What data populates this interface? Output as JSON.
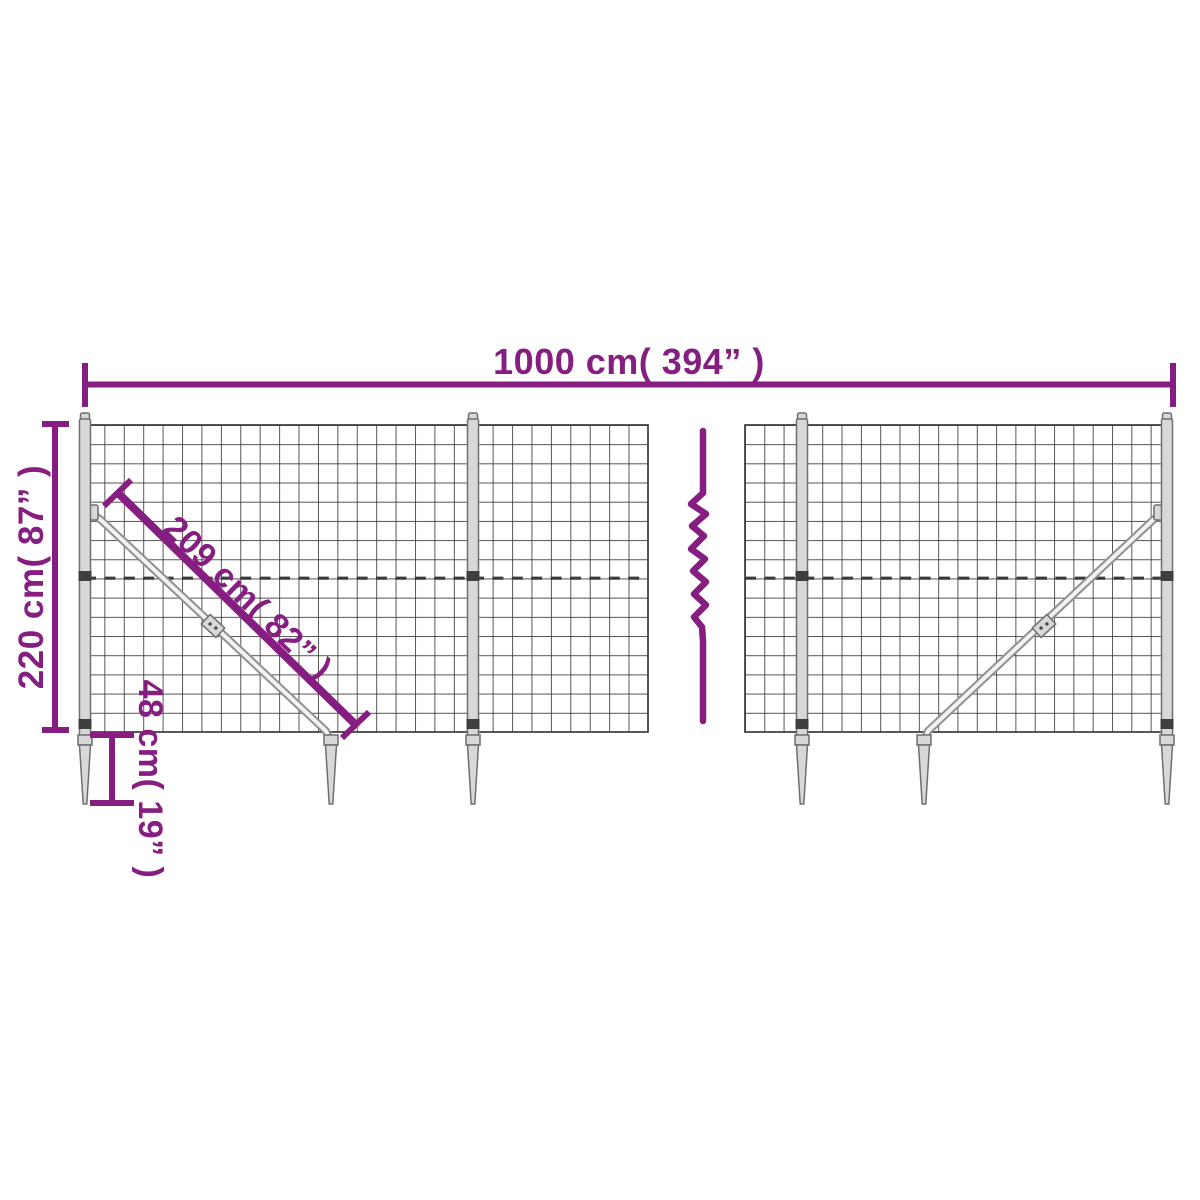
{
  "title": "Wire mesh fence with ground anchor spikes - dimension diagram",
  "colors": {
    "accent": "#851E80",
    "mesh": "#3A3A3A",
    "metal_fill": "#D8D8D8",
    "metal_stroke": "#6E6E6E",
    "brace_outer": "#909090",
    "brace_inner": "#F2F2F2",
    "clamp_dark": "#3F3F3F",
    "background": "#FFFFFF"
  },
  "dimensions": {
    "width_label": "1000 cm( 394” )",
    "height_label": "220 cm( 87” )",
    "diagonal_label": "209 cm( 82” )",
    "anchor_label": "48 cm( 19” )"
  }
}
